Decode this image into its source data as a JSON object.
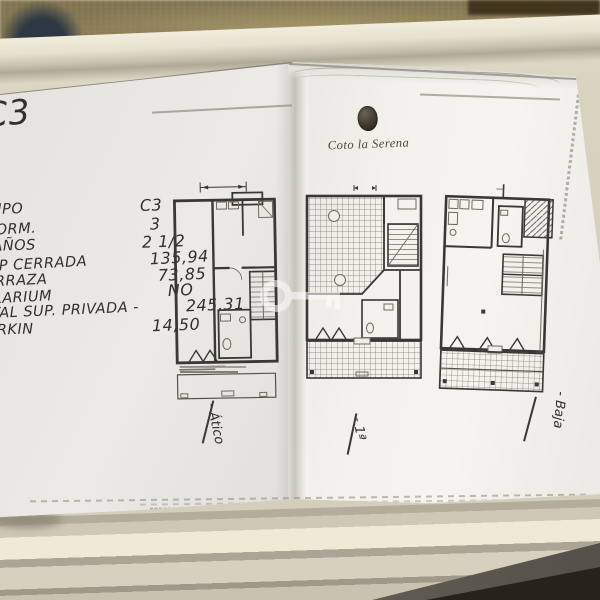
{
  "photo": {
    "description": "Photograph of a folded floor-plan sheet lying on a cream tray",
    "watermark_icon": "key-watermark-icon",
    "colors": {
      "tray": "#e9e3d2",
      "paper": "#f3f1eb",
      "ink": "#32302c",
      "fabric": "#8c7e58"
    }
  },
  "page_left": {
    "corner_code": "C3",
    "specs": [
      {
        "label": "TIPO",
        "value": "C3"
      },
      {
        "label": "DORM.",
        "value": "3"
      },
      {
        "label": "BAÑOS",
        "value": "2 1/2"
      },
      {
        "label": "SUP CERRADA",
        "value": "135,94"
      },
      {
        "label": "TERRAZA",
        "value": "73,85"
      },
      {
        "label": "SOLARIUM",
        "value": "NO"
      },
      {
        "label": "TOTAL SUP. PRIVADA -",
        "value": "245,31"
      },
      {
        "label": "PARKIN",
        "value": "14,50"
      }
    ],
    "plan_label": "- Ático"
  },
  "page_right": {
    "logo_text": "Coto la Serena",
    "logo_icon": "pinecone-emblem-icon",
    "plan1_label": "- 1ª",
    "plan2_label": "- Baja"
  }
}
